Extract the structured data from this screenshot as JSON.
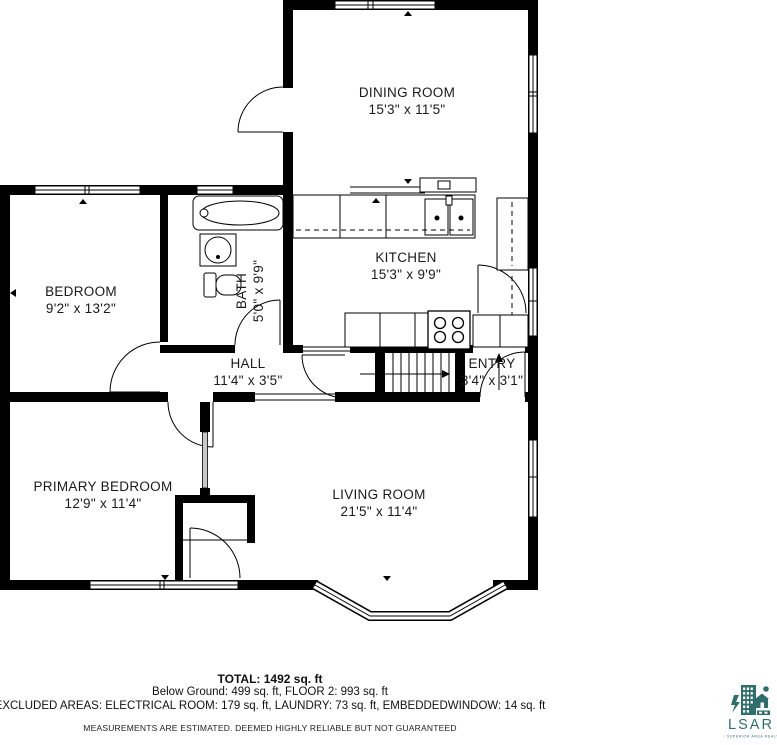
{
  "floorplan": {
    "rooms": [
      {
        "name": "DINING ROOM",
        "dims": "15'3\" x 11'5\""
      },
      {
        "name": "KITCHEN",
        "dims": "15'3\" x 9'9\""
      },
      {
        "name": "BEDROOM",
        "dims": "9'2\" x 13'2\""
      },
      {
        "name": "BATH",
        "dims": "5'0\" x 9'9\""
      },
      {
        "name": "HALL",
        "dims": "11'4\" x 3'5\""
      },
      {
        "name": "ENTRY",
        "dims": "3'4\" x 3'1\""
      },
      {
        "name": "PRIMARY BEDROOM",
        "dims": "12'9\" x 11'4\""
      },
      {
        "name": "LIVING ROOM",
        "dims": "21'5\" x 11'4\""
      }
    ]
  },
  "summary": {
    "total": "TOTAL: 1492 sq. ft",
    "areas": "Below Ground: 499 sq. ft, FLOOR 2: 993 sq. ft",
    "excluded": "EXCLUDED AREAS: ELECTRICAL ROOM: 179 sq. ft, LAUNDRY: 73 sq. ft, EMBEDDEDWINDOW: 14 sq. ft",
    "disclaimer": "MEASUREMENTS ARE ESTIMATED. DEEMED HIGHLY RELIABLE BUT NOT GUARANTEED"
  },
  "logo": {
    "acronym": "LSAR",
    "subtitle": "LAKE SUPERIOR AREA REALTORS",
    "color": "#2E6F6B"
  }
}
